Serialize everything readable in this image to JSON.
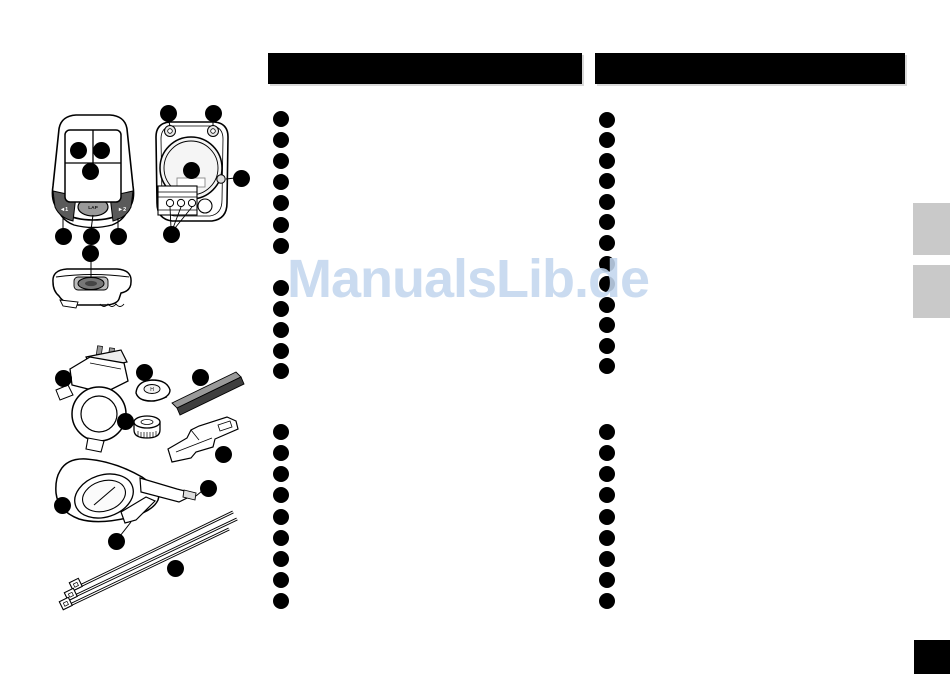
{
  "watermark": {
    "text": "ManualsLib.de",
    "color": "#c3d7ee"
  },
  "device_labels": {
    "button_left": "◄1",
    "button_center": "LAP",
    "button_right": "►2",
    "magnet_mark": "H"
  },
  "bullet_lists": {
    "left_column_x": 281,
    "right_column_x": 607,
    "left_groups": [
      [
        119,
        140,
        161,
        182,
        203,
        225,
        246
      ],
      [
        288,
        309,
        330,
        351,
        371
      ],
      [
        432,
        453,
        474,
        495,
        517,
        538,
        559,
        580,
        601
      ]
    ],
    "right_groups": [
      [
        120,
        140,
        161,
        181,
        202,
        222,
        243,
        264,
        284,
        305,
        325,
        346,
        366
      ],
      [
        432,
        453,
        474,
        495,
        517,
        538,
        559,
        580,
        601
      ]
    ]
  },
  "callouts": {
    "dots": [
      {
        "name": "front-display-left",
        "x": 78,
        "y": 150
      },
      {
        "name": "front-display-right",
        "x": 101,
        "y": 150
      },
      {
        "name": "front-display-bottom",
        "x": 90,
        "y": 171
      },
      {
        "name": "front-button-left",
        "x": 63,
        "y": 236
      },
      {
        "name": "front-button-lap",
        "x": 91,
        "y": 236
      },
      {
        "name": "front-button-right",
        "x": 118,
        "y": 236
      },
      {
        "name": "bottom-view-button",
        "x": 90,
        "y": 253
      },
      {
        "name": "back-screw-left",
        "x": 168,
        "y": 113
      },
      {
        "name": "back-screw-right",
        "x": 213,
        "y": 113
      },
      {
        "name": "back-battery",
        "x": 191,
        "y": 170
      },
      {
        "name": "back-side-button",
        "x": 241,
        "y": 178
      },
      {
        "name": "back-contacts",
        "x": 171,
        "y": 234
      },
      {
        "name": "handlebar-bracket",
        "x": 63,
        "y": 378
      },
      {
        "name": "spoke-magnet",
        "x": 144,
        "y": 372
      },
      {
        "name": "rubber-shim",
        "x": 200,
        "y": 377
      },
      {
        "name": "wheel-magnet",
        "x": 125,
        "y": 421
      },
      {
        "name": "rail-adapter",
        "x": 223,
        "y": 454
      },
      {
        "name": "sensor-body",
        "x": 62,
        "y": 505
      },
      {
        "name": "sensor-pin",
        "x": 208,
        "y": 488
      },
      {
        "name": "sensor-arm",
        "x": 116,
        "y": 541
      },
      {
        "name": "cable-ties",
        "x": 175,
        "y": 568
      }
    ]
  }
}
